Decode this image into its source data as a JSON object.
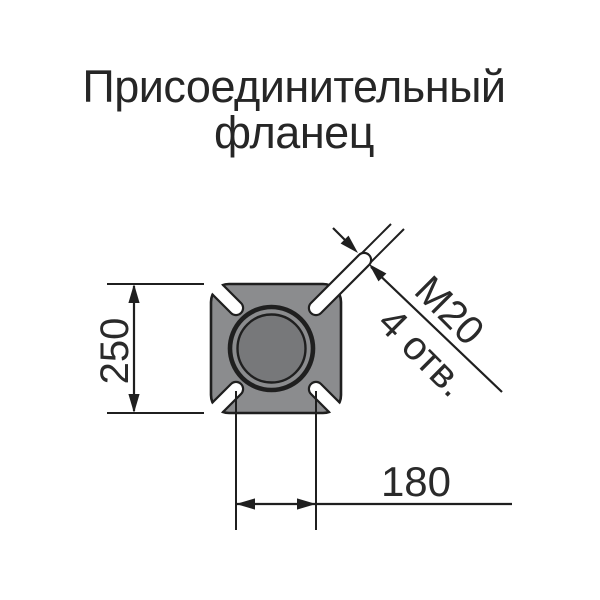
{
  "title": {
    "line1": "Присоединительный",
    "line2": "фланец"
  },
  "drawing": {
    "dim_height": "250",
    "dim_spacing": "180",
    "thread_label": "М20",
    "holes_label": "4 отв."
  },
  "colors": {
    "body": "#8b8c8e",
    "bore": "#77787a",
    "line": "#1f1f1f",
    "text": "#2a2a2a",
    "background": "#ffffff"
  }
}
